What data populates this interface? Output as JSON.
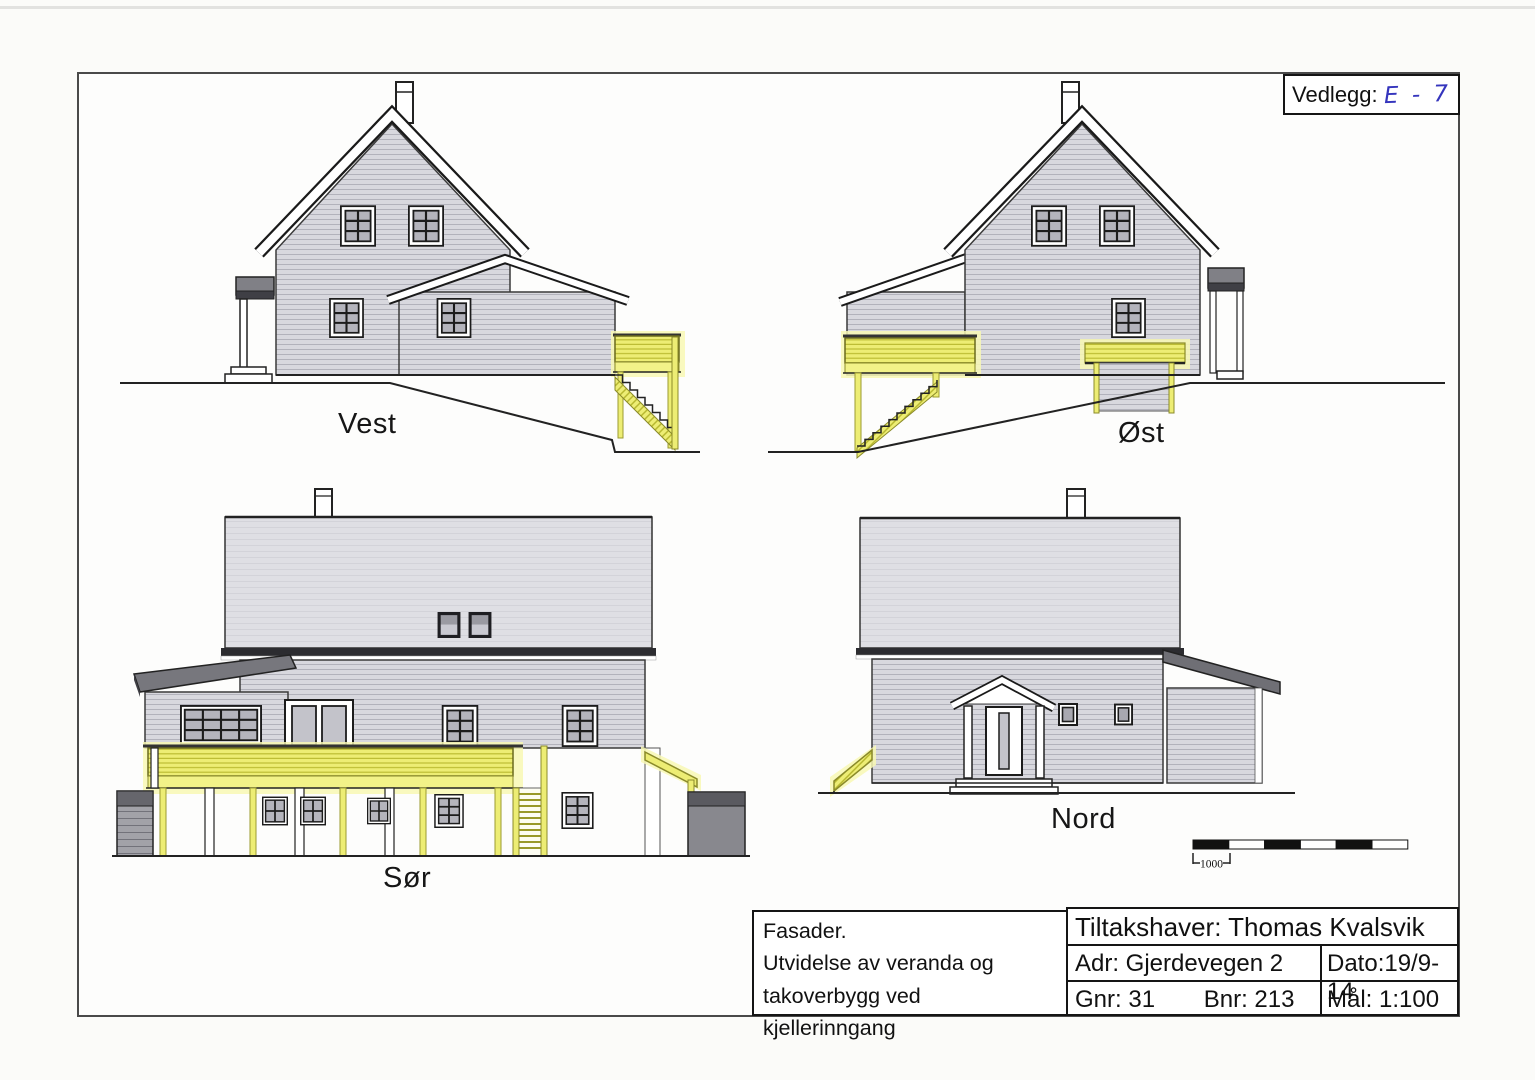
{
  "vedlegg": {
    "label": "Vedlegg:",
    "value": "E - 7",
    "value_color": "#3535bd"
  },
  "elevations": [
    {
      "id": "vest",
      "label": "Vest"
    },
    {
      "id": "ost",
      "label": "Øst"
    },
    {
      "id": "sor",
      "label": "Sør"
    },
    {
      "id": "nord",
      "label": "Nord"
    }
  ],
  "scale_bar": {
    "label": "1000"
  },
  "title_block": {
    "description_lines": [
      "Fasader.",
      "Utvidelse av veranda og",
      "takoverbygg ved kjellerinngang"
    ],
    "tiltakshaver": "Tiltakshaver: Thomas Kvalsvik",
    "adr": "Adr: Gjerdevegen 2",
    "dato": "Dato:19/9-14",
    "gnr": "Gnr: 31",
    "bnr": "Bnr: 213",
    "mal": "Mål: 1:100"
  },
  "colors": {
    "highlight_yellow": "#eded74",
    "pale_yellow_glow": "#f8f8b4",
    "wall_gray": "#d8d8de",
    "roof_gray": "#dfdfe4",
    "dark_roof_gray": "#77777d",
    "eave_black": "#2c2c30",
    "handwriting_blue": "#3535bd"
  }
}
